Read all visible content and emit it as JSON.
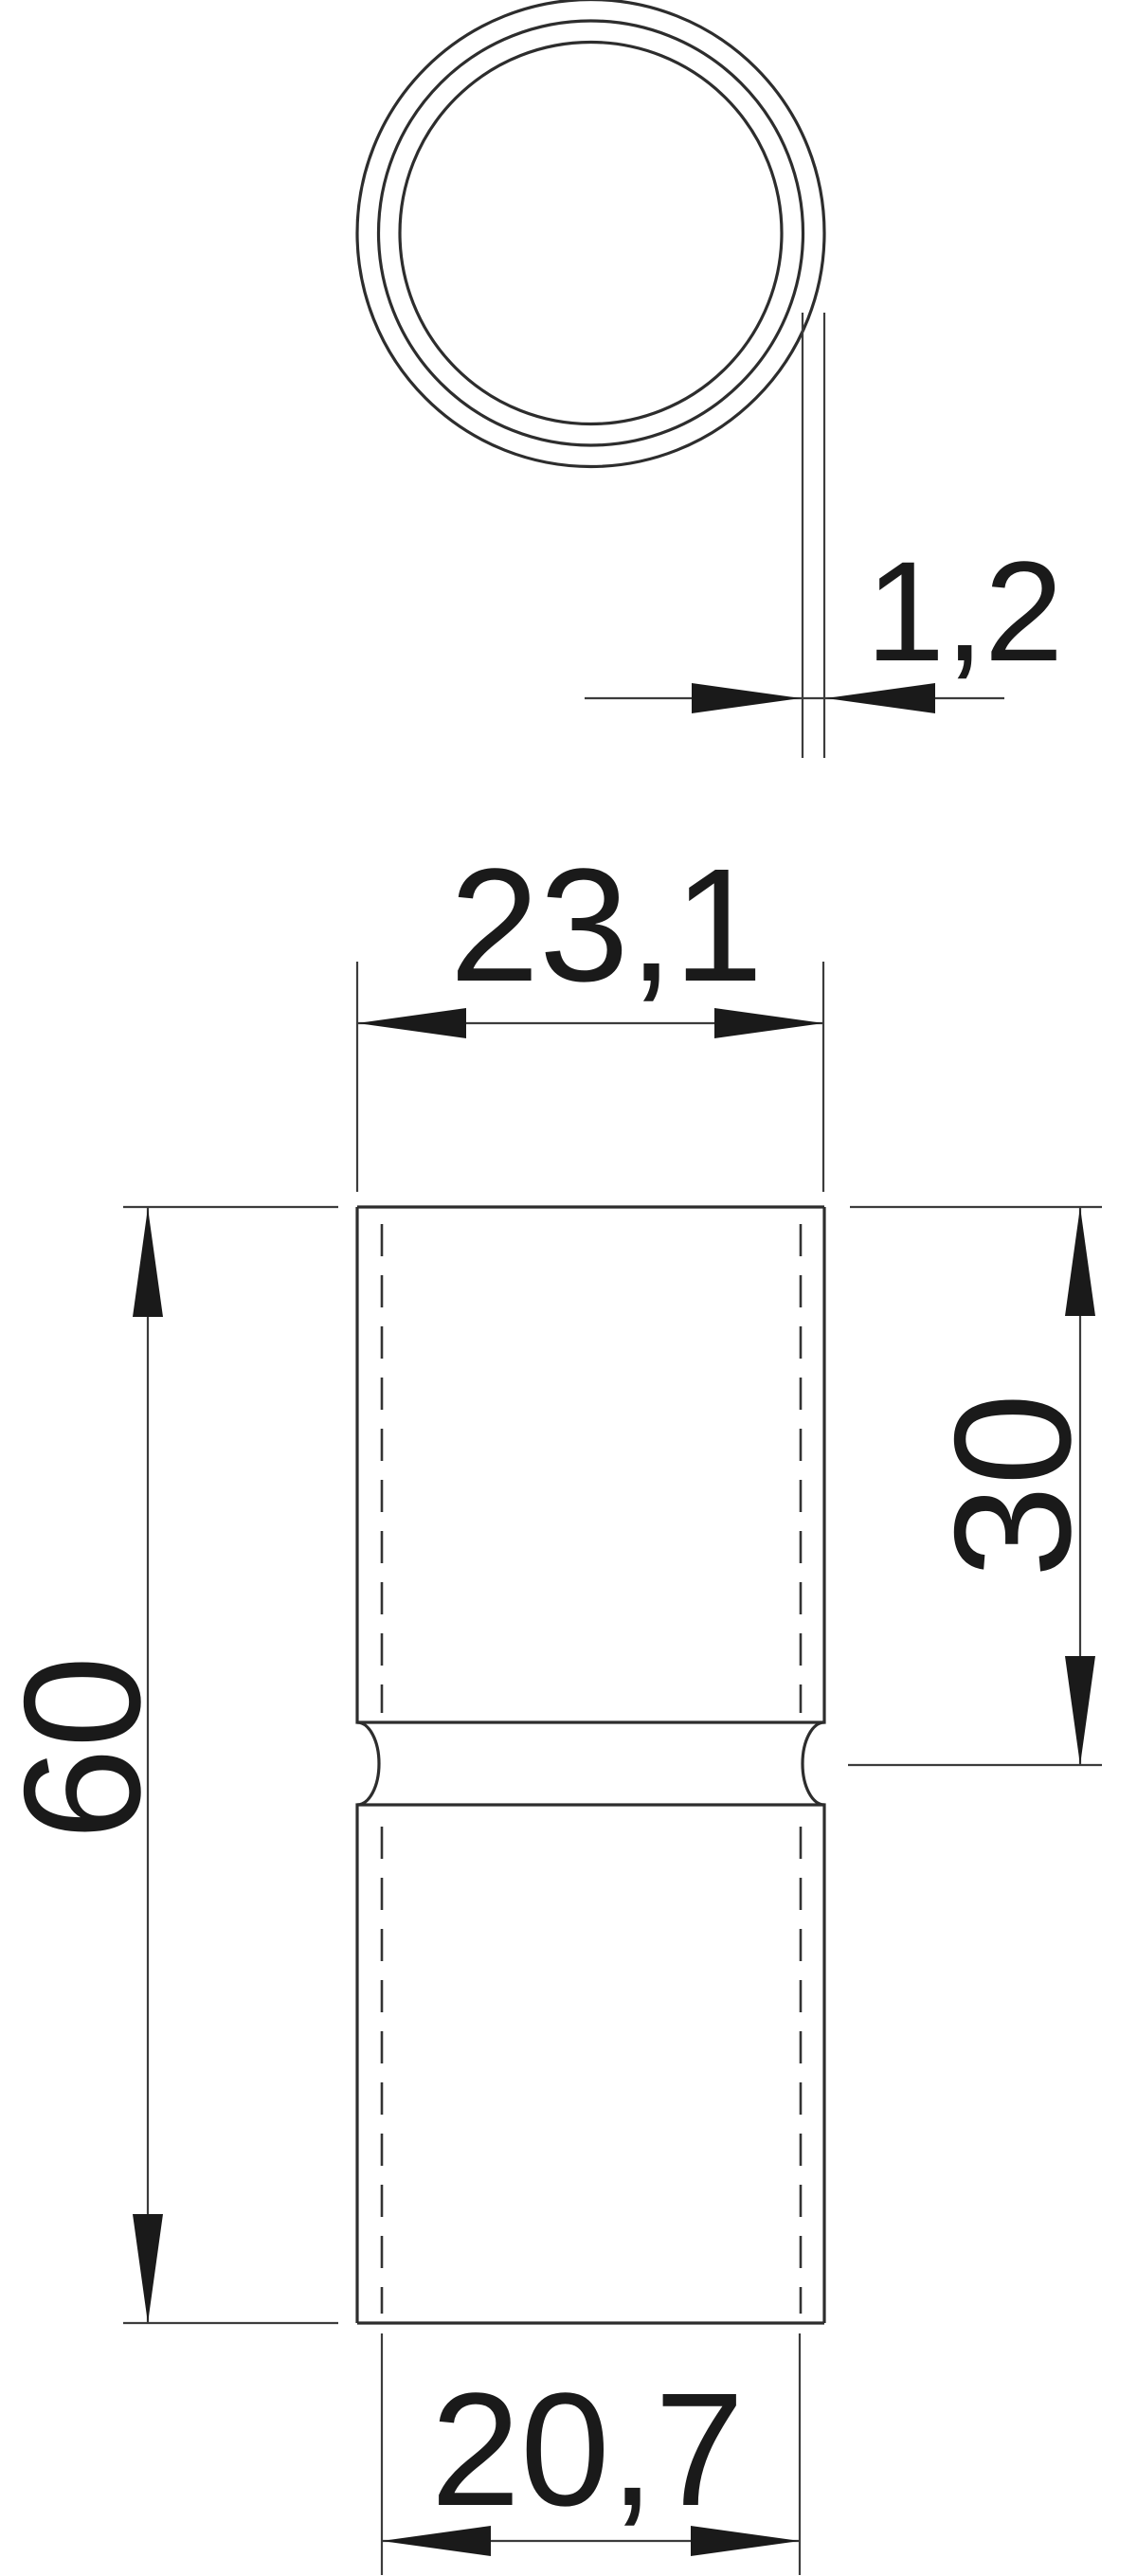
{
  "drawing": {
    "kind": "technical-drawing",
    "background": "#ffffff",
    "line_color": "#2d2d2d",
    "text_color": "#1a1a1a",
    "views": {
      "top_view": {
        "description": "tube cross-section, three concentric circles"
      },
      "front_view": {
        "description": "sleeve elevation with center waist notch and hidden inner lines"
      }
    },
    "dimensions": {
      "wall_thickness": {
        "label": "1,2",
        "value_mm": 1.2
      },
      "outer_width": {
        "label": "23,1",
        "value_mm": 23.1
      },
      "overall_length": {
        "label": "60",
        "value_mm": 60
      },
      "upper_section_length": {
        "label": "30",
        "value_mm": 30
      },
      "inner_width": {
        "label": "20,7",
        "value_mm": 20.7
      }
    }
  }
}
